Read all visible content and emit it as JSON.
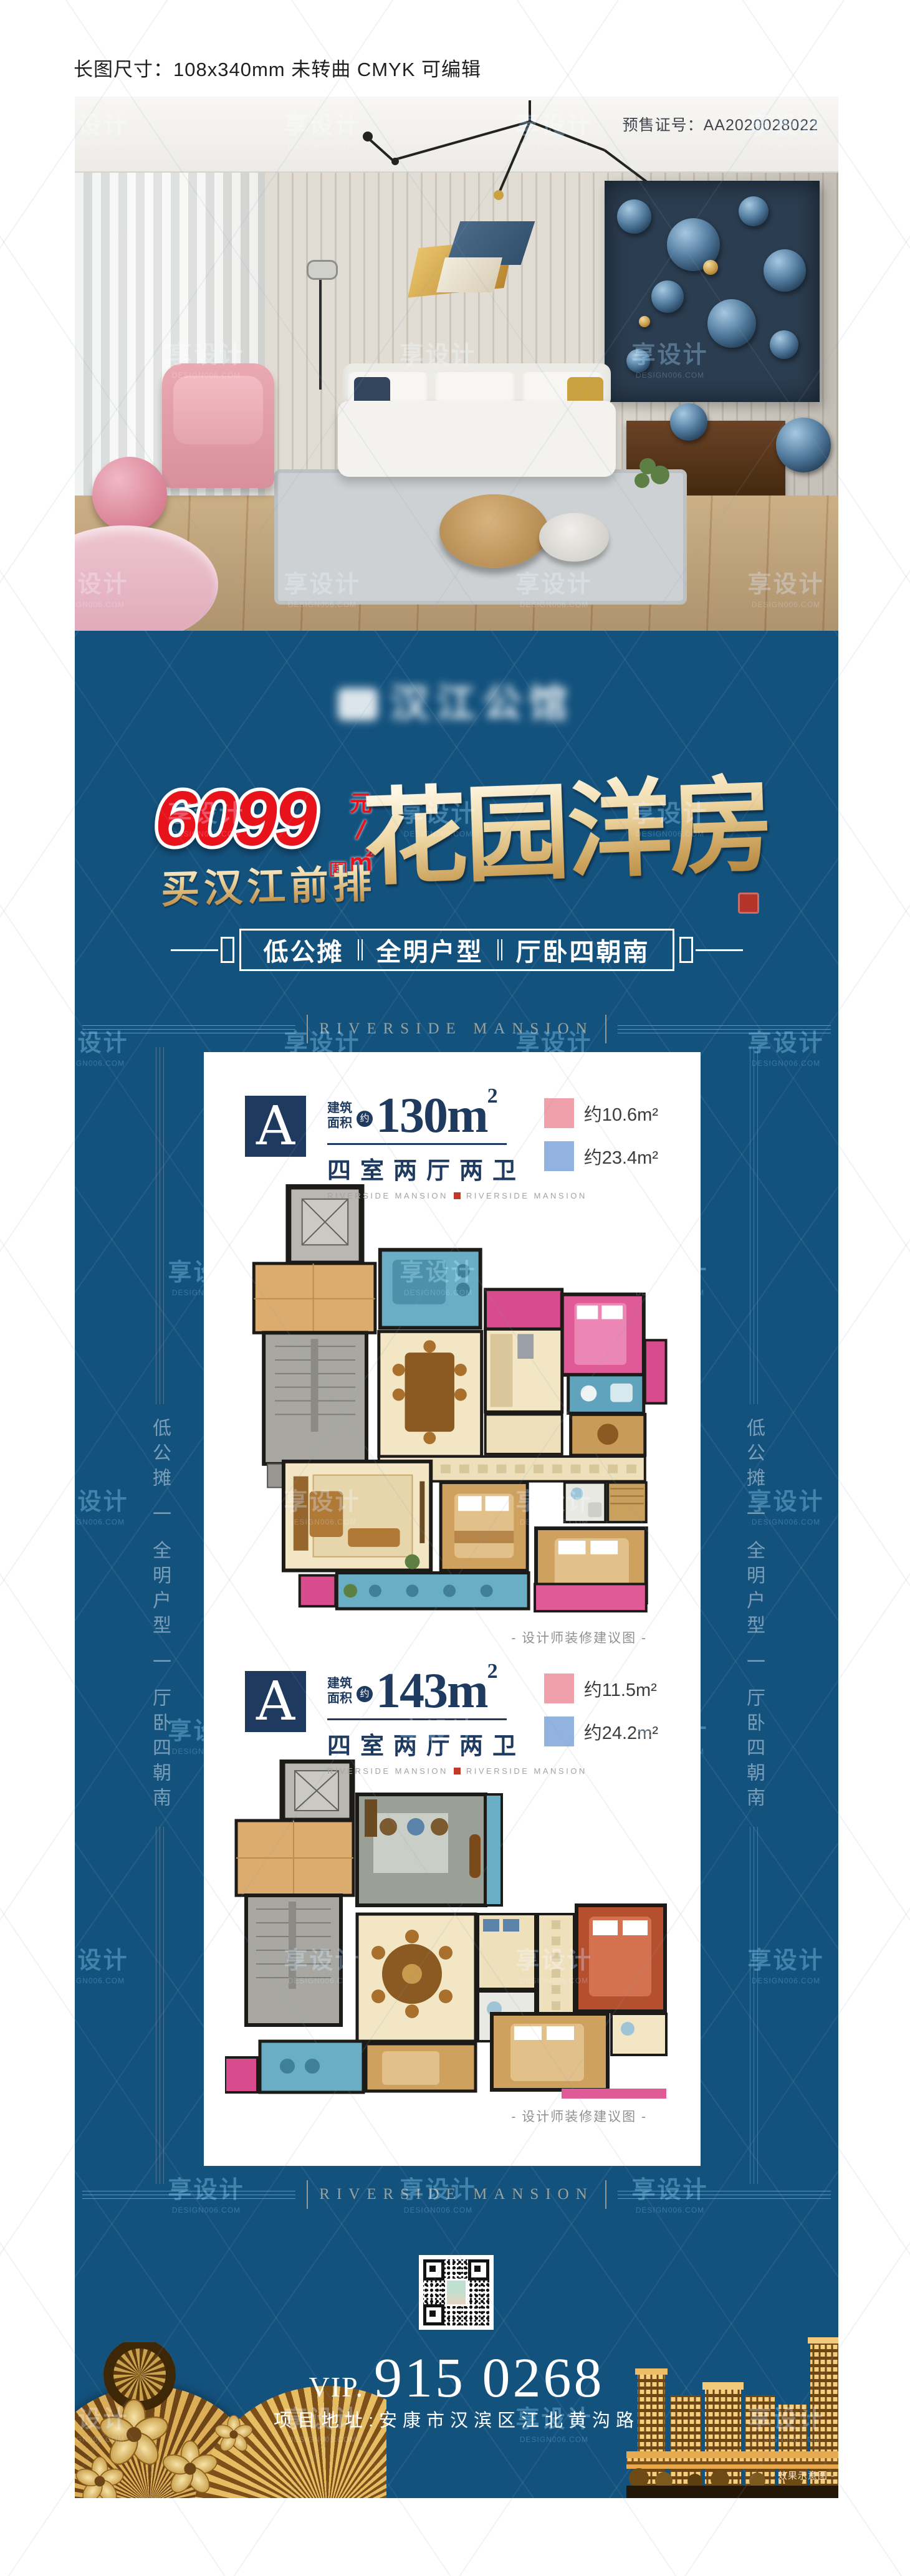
{
  "header": {
    "spec": "长图尺寸：108x340mm 未转曲 CMYK 可编辑",
    "presale": "预售证号：AA2020028022"
  },
  "watermark": {
    "text": "享设计",
    "sub": "DESIGN006.COM"
  },
  "poster": {
    "logo": "汉江公馆",
    "price": {
      "number": "6099",
      "yuan": "元",
      "sqm": "㎡",
      "qi": "起"
    },
    "subtitle": "买汉江前排",
    "headline": "花园洋房",
    "banner": [
      "低公摊",
      "全明户型",
      "厅卧四朝南"
    ],
    "frame": {
      "label": "RIVERSIDE MANSION",
      "side": "低公摊 一 全明户型 一 厅卧四朝南"
    },
    "render_caption": "- 效果示意图 -"
  },
  "units": [
    {
      "letter": "A",
      "area_l1": "建筑",
      "area_l2": "面积",
      "approx": "约",
      "area": "130m",
      "sup": "2",
      "rooms": "四室两厅两卫",
      "ribbon": "RIVERSIDE MANSION",
      "legend_pink": "约10.6m²",
      "legend_blue": "约23.4m²",
      "caption": "- 设计师装修建议图 -"
    },
    {
      "letter": "A",
      "area_l1": "建筑",
      "area_l2": "面积",
      "approx": "约",
      "area": "143m",
      "sup": "2",
      "rooms": "四室两厅两卫",
      "ribbon": "RIVERSIDE MANSION",
      "legend_pink": "约11.5m²",
      "legend_blue": "约24.2m²",
      "caption": "- 设计师装修建议图 -"
    }
  ],
  "contact": {
    "vip": "VIP.",
    "phone": "915 0268",
    "address": "项目地址:安康市汉滨区江北黄沟路"
  }
}
